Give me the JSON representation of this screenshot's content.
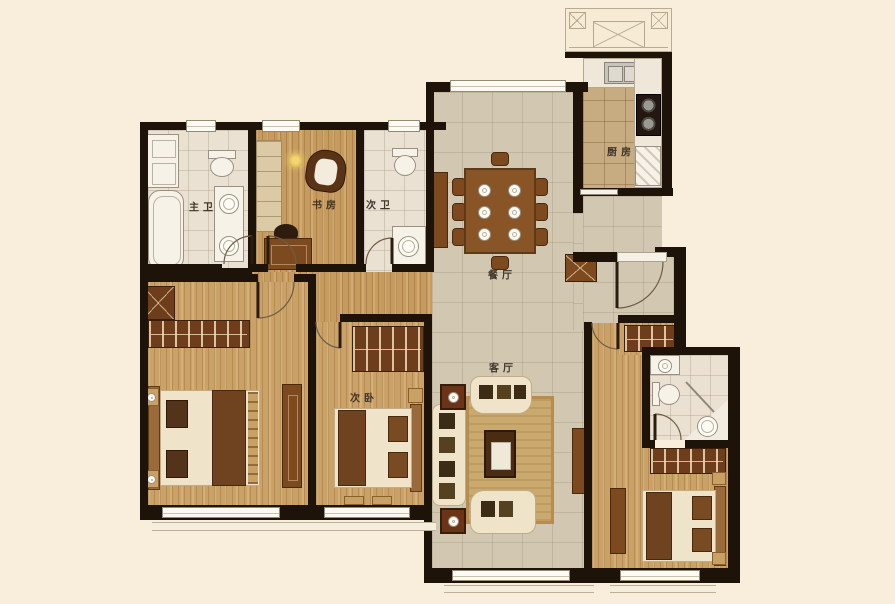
{
  "plan": {
    "type": "apartment-floor-plan",
    "rooms": [
      {
        "id": "master-bath",
        "label": "主卫"
      },
      {
        "id": "study",
        "label": "书房"
      },
      {
        "id": "second-bath",
        "label": "次卫"
      },
      {
        "id": "dining-room",
        "label": "餐厅"
      },
      {
        "id": "kitchen",
        "label": "厨房"
      },
      {
        "id": "living-room",
        "label": "客厅"
      },
      {
        "id": "second-bedroom",
        "label": "次卧"
      }
    ],
    "colors": {
      "background": "#f8eedb",
      "wall": "#1d1309",
      "wood_floor": "#c59b60",
      "tile_floor": "#d2c7b1",
      "kitchen_floor": "#c7ac81",
      "bath_floor": "#ebe1d2",
      "furniture_brown": "#7d4a20",
      "fixture_white": "#f6f2e8"
    }
  }
}
